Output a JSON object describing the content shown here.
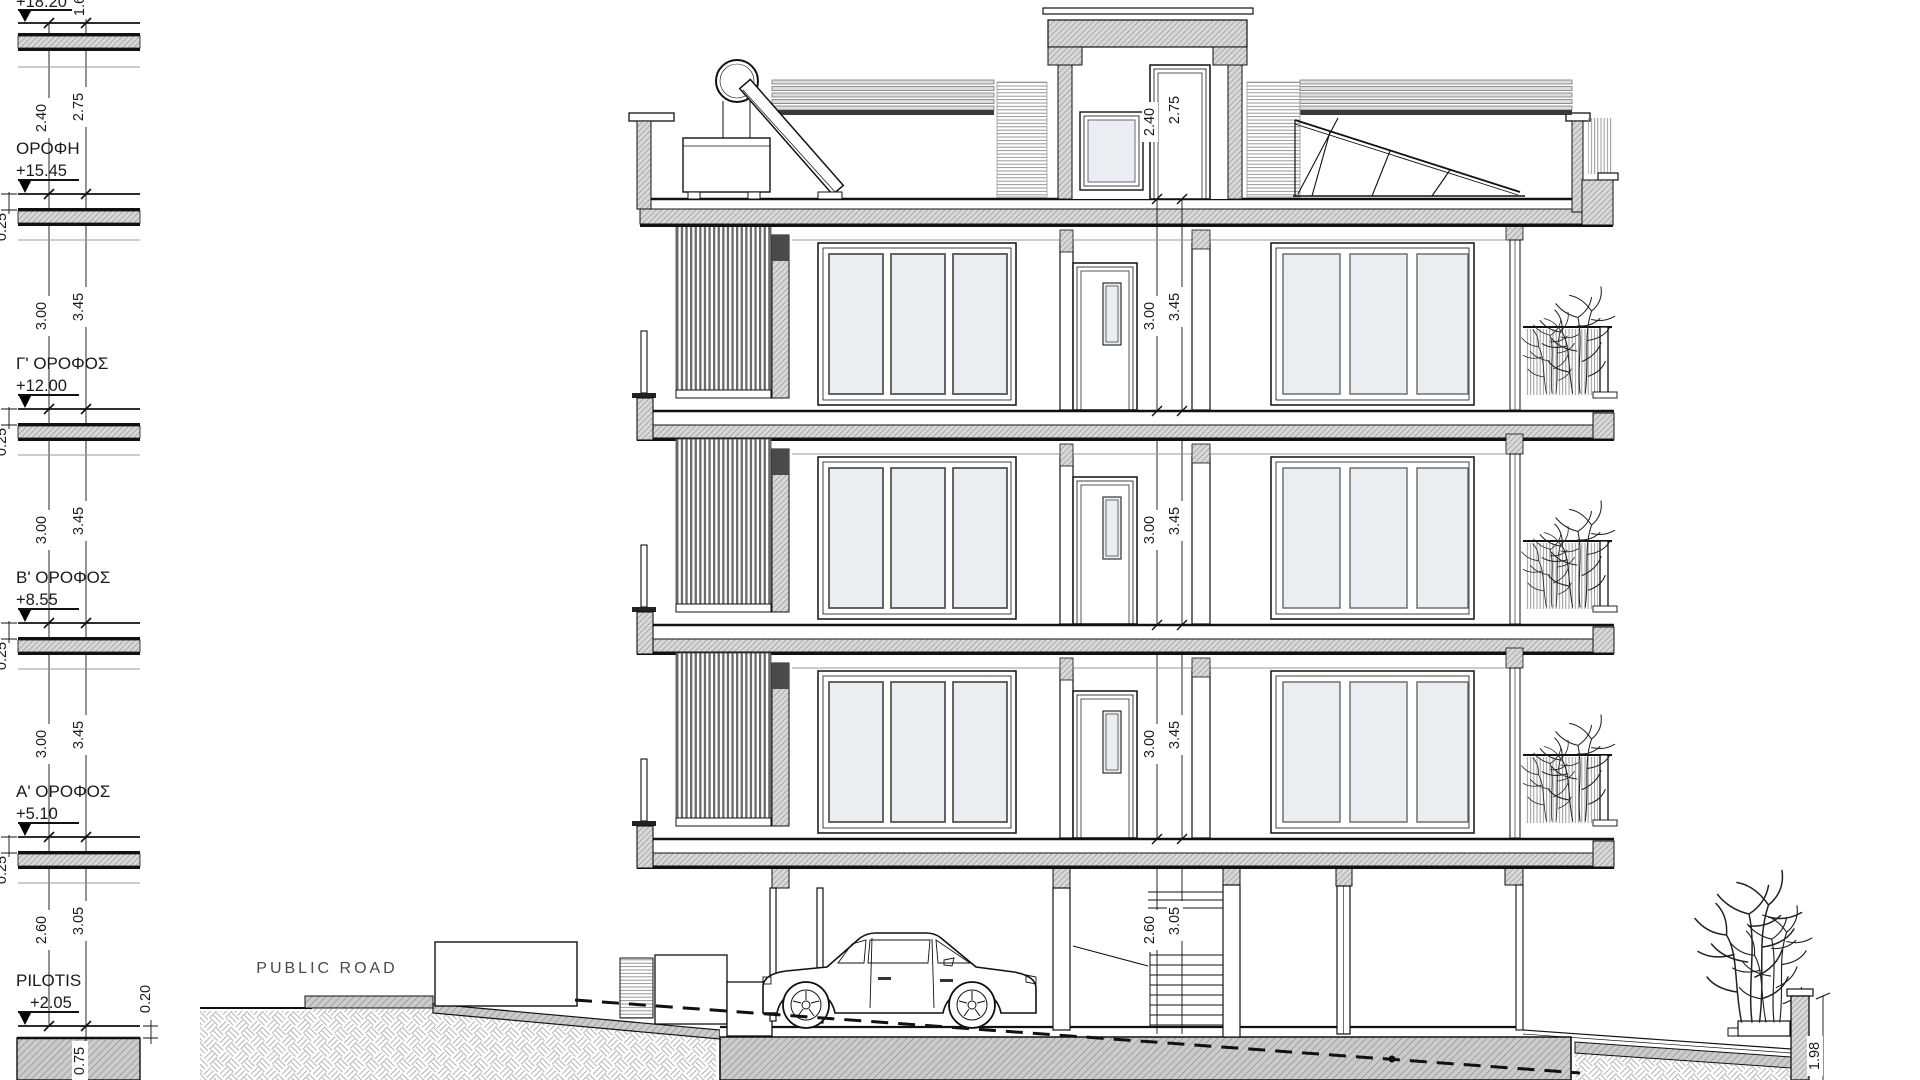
{
  "drawing": {
    "road_label": "PUBLIC ROAD"
  },
  "levels": [
    {
      "name": "",
      "elevation": "+18.20"
    },
    {
      "name": "ΟΡΟΦΗ",
      "elevation": "+15.45"
    },
    {
      "name": "Γ' ΟΡΟΦΟΣ",
      "elevation": "+12.00"
    },
    {
      "name": "Β' ΟΡΟΦΟΣ",
      "elevation": "+8.55"
    },
    {
      "name": "Α' ΟΡΟΦΟΣ",
      "elevation": "+5.10"
    },
    {
      "name": "PILOTIS",
      "elevation": "+2.05"
    }
  ],
  "dimensions": {
    "slab_thickness": "0.25",
    "roof_floor_clear": "2.40",
    "roof_floor_total": "2.75",
    "typical_floor_clear": "3.00",
    "typical_floor_total": "3.45",
    "pilotis_clear": "2.60",
    "pilotis_total": "3.05",
    "ground_slab": "0.75",
    "floor_step": "0.20",
    "rear_wall_height": "1.98",
    "top_partial": "1.60"
  },
  "colors": {
    "glass": "#e9eef2",
    "paper": "#ffffff",
    "line": "#111111"
  }
}
